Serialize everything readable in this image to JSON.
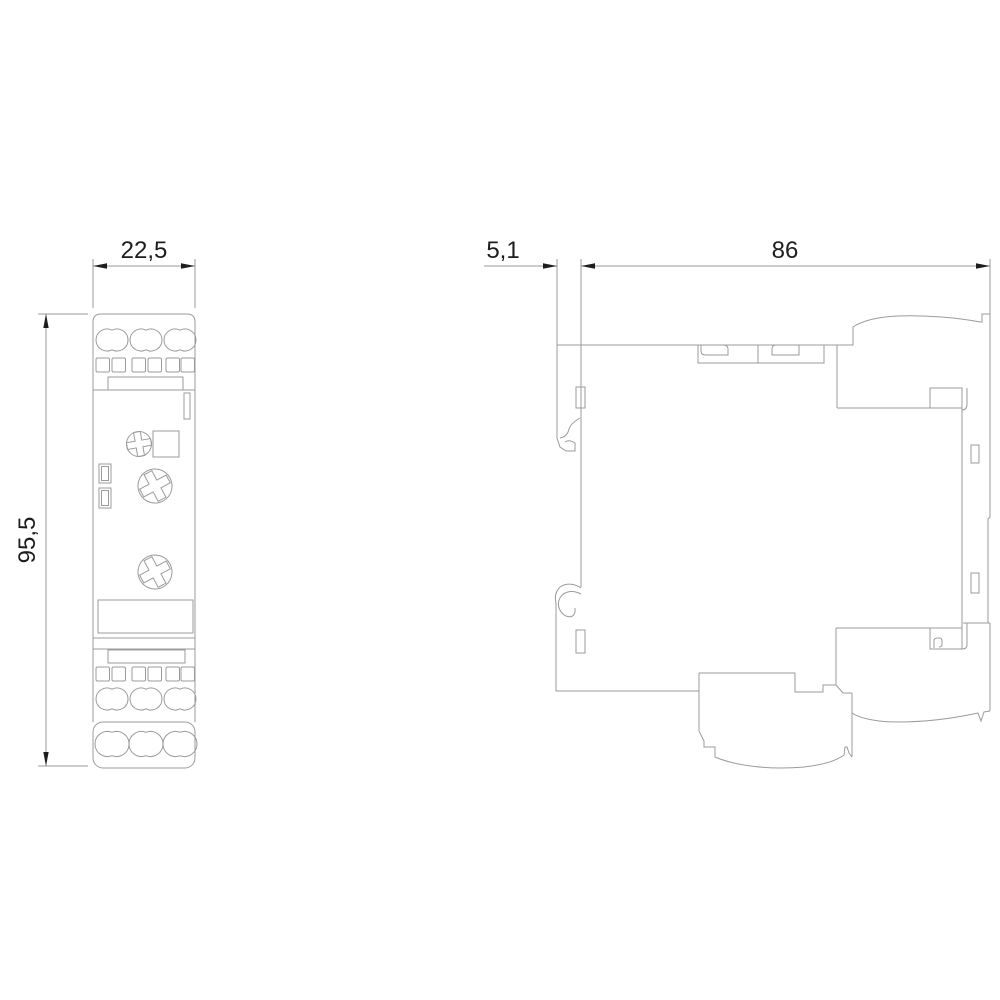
{
  "drawing": {
    "type": "technical-dimension-drawing",
    "subject": "din-rail-relay-module",
    "dimensions": {
      "width_mm": {
        "value": "22,5"
      },
      "height_mm": {
        "value": "95,5"
      },
      "clip_depth_mm": {
        "value": "5,1"
      },
      "body_depth_mm": {
        "value": "86"
      }
    },
    "colors": {
      "line": "#9b9b9b",
      "text": "#1d1d1d",
      "background": "#ffffff"
    }
  }
}
